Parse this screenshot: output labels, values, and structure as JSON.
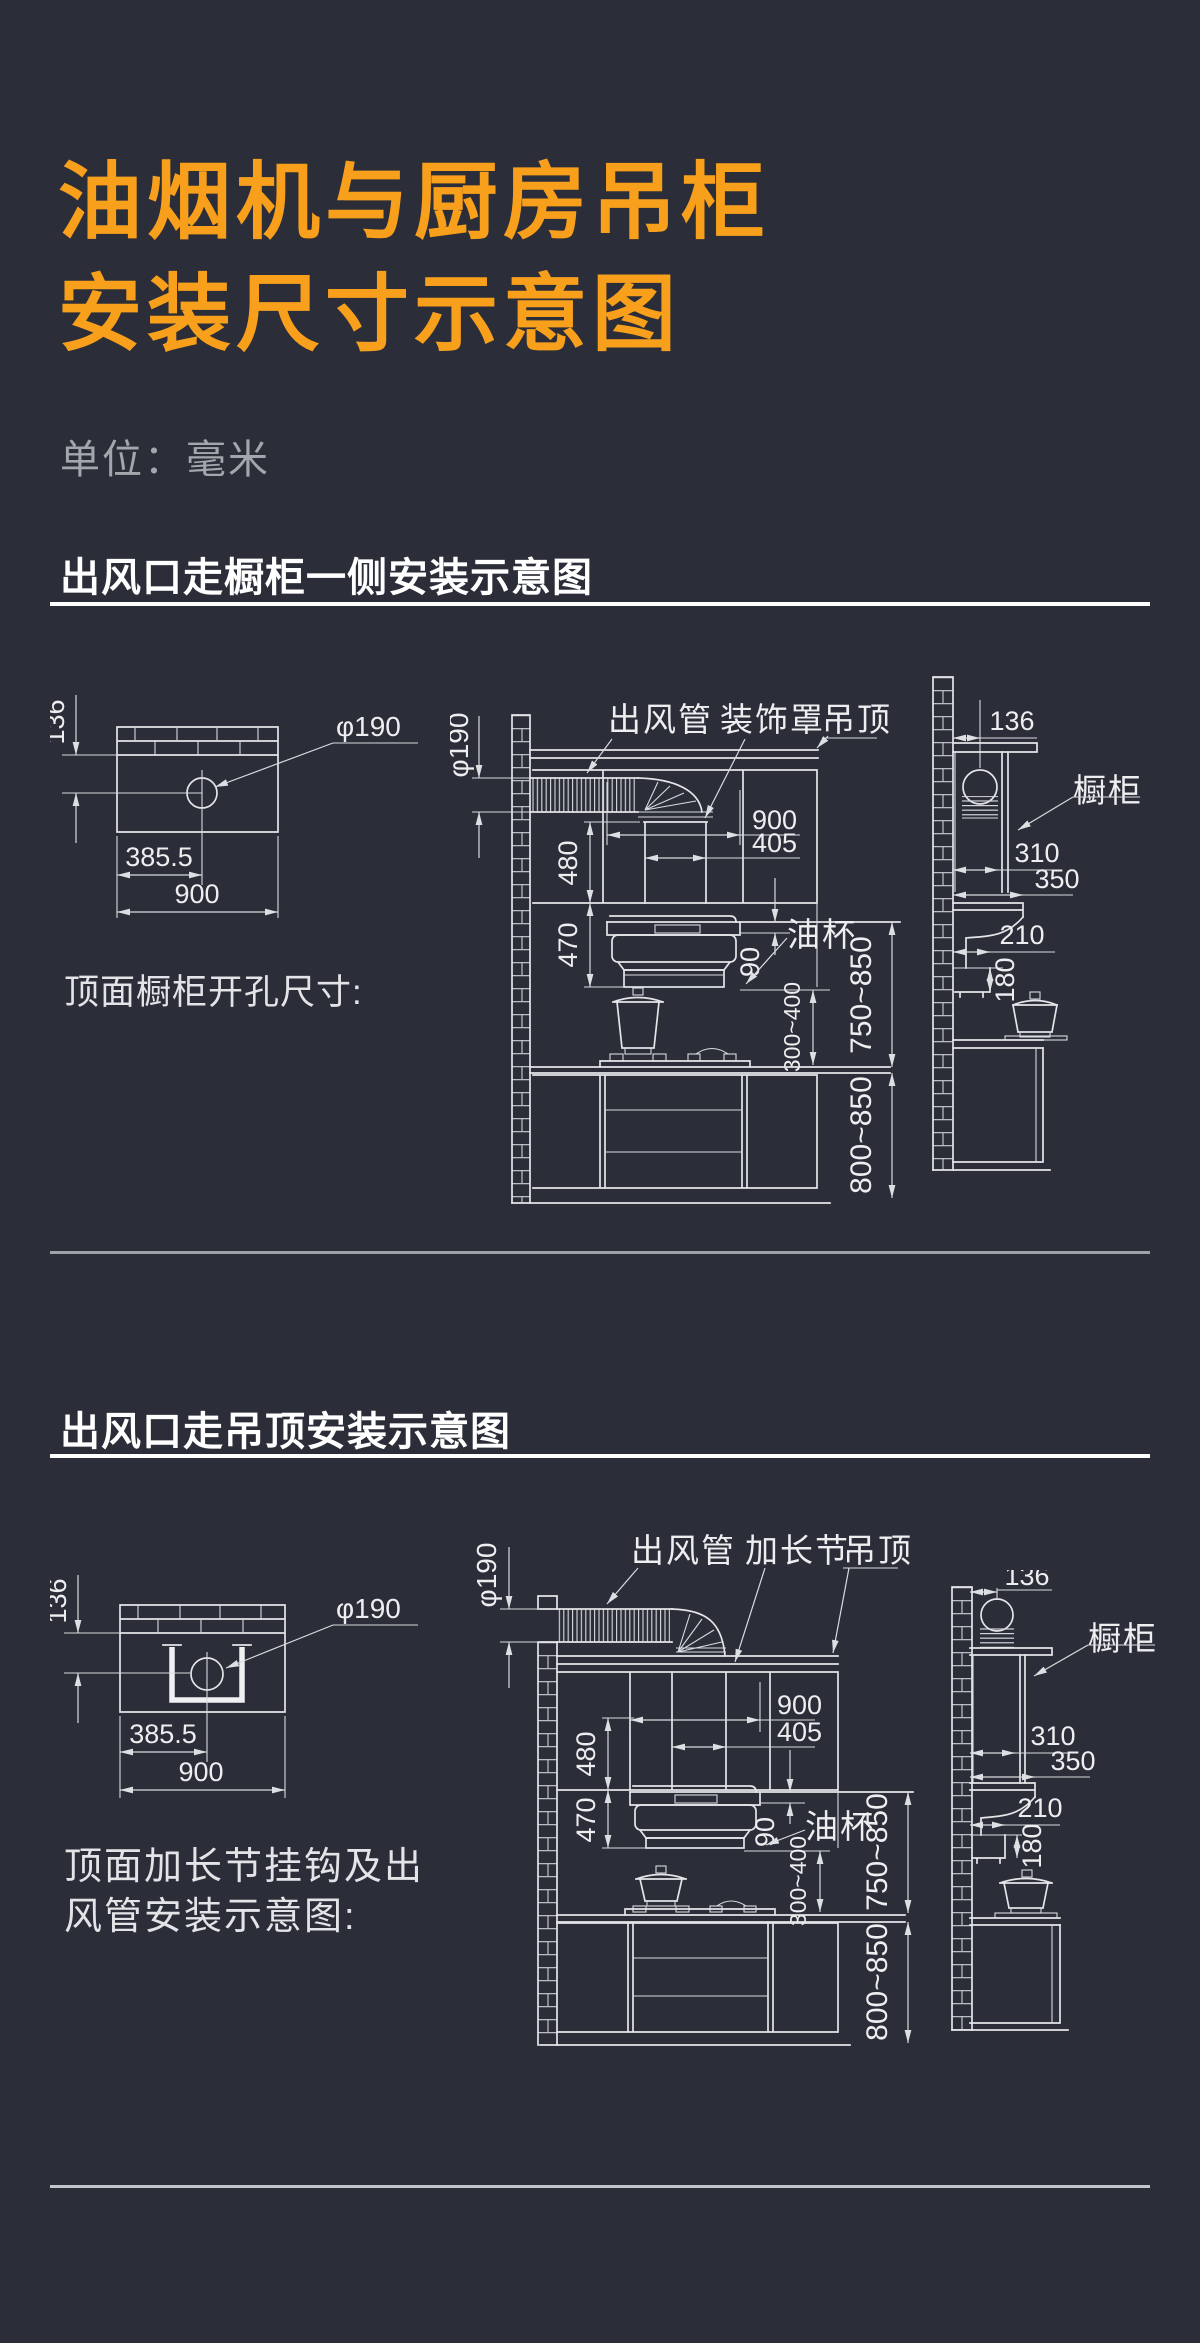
{
  "page": {
    "background": "#2B2D38",
    "accent_orange": "#F8A01B",
    "line_color": "#E3E5E8"
  },
  "header": {
    "title_line1": "油烟机与厨房吊柜",
    "title_line2": "安装尺寸示意图",
    "unit": "单位：毫米"
  },
  "section1": {
    "heading": "出风口走橱柜一侧安装示意图",
    "caption": "顶面橱柜开孔尺寸:",
    "topview": {
      "wall_offset": "136",
      "hole_offset": "385.5",
      "panel_width": "900",
      "hole_diameter": "φ190"
    },
    "elevation": {
      "label_duct": "出风管",
      "label_cover": "装饰罩",
      "label_ceiling": "吊顶",
      "duct_diameter": "φ190",
      "hood_width": "900",
      "cover_width": "405",
      "cover_height": "480",
      "hood_height": "470",
      "cup_height": "90",
      "label_oil_cup": "油杯",
      "hood_to_counter": "300~400",
      "cabinet_to_counter": "750~850",
      "counter_to_floor": "800~850"
    },
    "sideview": {
      "wall_offset": "136",
      "label_cabinet": "橱柜",
      "depth_310": "310",
      "depth_350": "350",
      "depth_210": "210",
      "height_180": "180"
    }
  },
  "section2": {
    "heading": "出风口走吊顶安装示意图",
    "caption_line1": "顶面加长节挂钩及出",
    "caption_line2": "风管安装示意图:",
    "topview": {
      "wall_offset": "136",
      "hole_offset": "385.5",
      "panel_width": "900",
      "hole_diameter": "φ190"
    },
    "elevation": {
      "label_duct": "出风管",
      "label_extension": "加长节",
      "label_ceiling": "吊顶",
      "duct_diameter": "φ190",
      "hood_width": "900",
      "cover_width": "405",
      "cover_height": "480",
      "hood_height": "470",
      "cup_height": "90",
      "label_oil_cup": "油杯",
      "hood_to_counter": "300~400",
      "cabinet_to_counter": "750~850",
      "counter_to_floor": "800~850"
    },
    "sideview": {
      "wall_offset": "136",
      "label_cabinet": "橱柜",
      "depth_310": "310",
      "depth_350": "350",
      "depth_210": "210",
      "height_180": "180"
    }
  }
}
